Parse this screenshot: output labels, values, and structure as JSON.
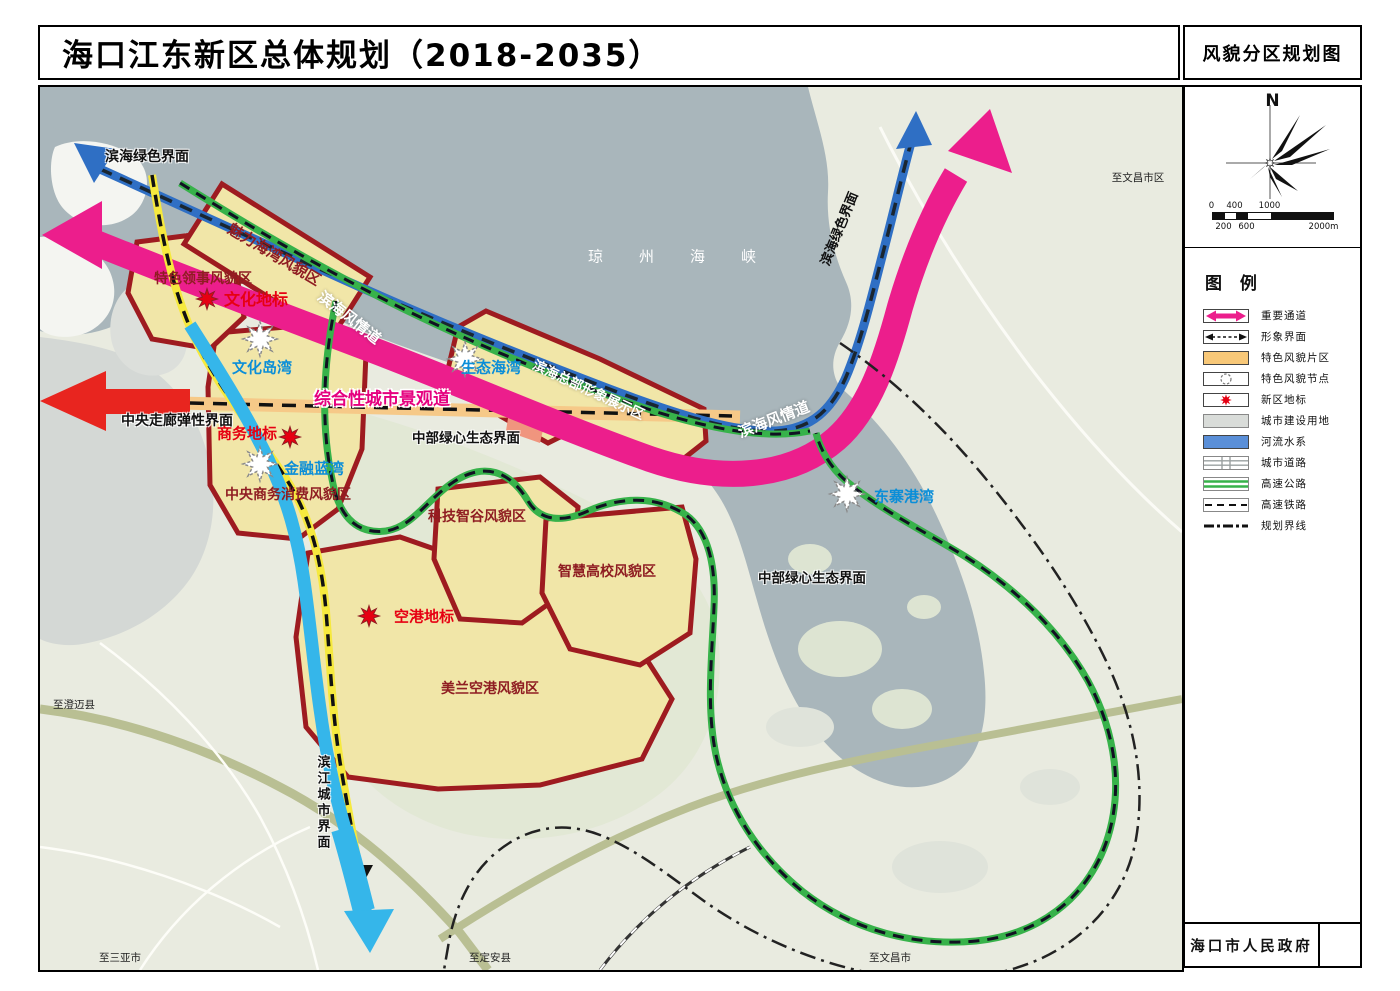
{
  "title_bar": {
    "main_title": "海口江东新区总体规划（2018-2035）",
    "sheet_title": "风貌分区规划图"
  },
  "compass": {
    "north_label": "N"
  },
  "scale_bar": {
    "upper_ticks": [
      "0",
      "400",
      "1000"
    ],
    "lower_ticks": [
      "200",
      "600",
      "2000m"
    ]
  },
  "legend": {
    "title": "图 例",
    "items": [
      {
        "icon": "pink-double-arrow-icon",
        "label": "重要通道"
      },
      {
        "icon": "dashed-double-arrow-icon",
        "label": "形象界面"
      },
      {
        "icon": "orange-zone-swatch",
        "label": "特色风貌片区"
      },
      {
        "icon": "node-circle-icon",
        "label": "特色风貌节点"
      },
      {
        "icon": "red-star-icon",
        "label": "新区地标"
      },
      {
        "icon": "gray-swatch",
        "label": "城市建设用地"
      },
      {
        "icon": "blue-swatch",
        "label": "河流水系"
      },
      {
        "icon": "road-icon",
        "label": "城市道路"
      },
      {
        "icon": "highway-icon",
        "label": "高速公路"
      },
      {
        "icon": "railway-icon",
        "label": "高速铁路"
      },
      {
        "icon": "dashdot-line-icon",
        "label": "规划界线"
      }
    ]
  },
  "footer": {
    "publisher": "海口市人民政府"
  },
  "map": {
    "sea_name": "琼州海峡",
    "zones": {
      "charm_bay": "魅力海湾风貌区",
      "consular": "特色领事风貌区",
      "cbd_consumption": "中央商务消费风貌区",
      "coastal_hq": "滨海总部形象展示区",
      "tech_valley": "科技智谷风貌区",
      "smart_campus": "智慧高校风貌区",
      "meilan_airport": "美兰空港风貌区"
    },
    "nodes": {
      "culture_island_bay": "文化岛湾",
      "finance_blue_bay": "金融蓝湾",
      "eco_bay": "生态海湾",
      "dongzhai_bay": "东寨港湾"
    },
    "landmarks": {
      "culture": "文化地标",
      "business": "商务地标",
      "airport": "空港地标"
    },
    "corridors": {
      "coastal_style_road": "滨海风情道",
      "comprehensive_landscape_road": "综合性城市景观道"
    },
    "interfaces": {
      "coastal_green": "滨海绿色界面",
      "central_corridor_elastic": "中央走廊弹性界面",
      "central_green_heart": "中部绿心生态界面",
      "riverside_city": "滨江城市界面"
    },
    "directions": {
      "to_chengmai": "至澄迈县",
      "to_sanya": "至三亚市",
      "to_dingan": "至定安县",
      "to_wenchang": "至文昌市",
      "to_wenchang_urban": "至文昌市区"
    }
  },
  "colors": {
    "corridor_pink": "#ec1e8c",
    "zone_fill": "#f1e6a8",
    "zone_border": "#9e1b20",
    "sea_water": "#a9b6bb",
    "river_highlight": "#35b6ea",
    "node_text_blue": "#0b8ed8",
    "landmark_red": "#e60012",
    "green_line": "#37b24a",
    "coastal_interface_blue": "#2f6fc4",
    "riverside_interface_yellow": "#f6e93e"
  }
}
